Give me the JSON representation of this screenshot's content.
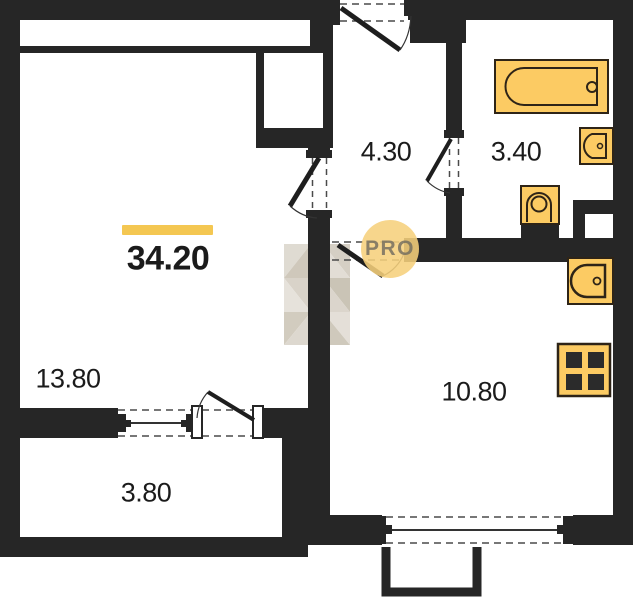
{
  "meta": {
    "type": "apartment-floor-plan"
  },
  "total_area": {
    "value": "34.20"
  },
  "rooms": {
    "living": {
      "area": "13.80"
    },
    "hallway": {
      "area": "4.30"
    },
    "bathroom": {
      "area": "3.40"
    },
    "kitchen": {
      "area": "10.80"
    },
    "balcony": {
      "area": "3.80"
    }
  },
  "watermark": {
    "badge": "PRO"
  },
  "colors": {
    "wall": "#262626",
    "fixture_fill": "#fccb63",
    "fixture_outline": "#2e2417",
    "accent_bar": "#f4c752",
    "badge_bg": "#f6d07c",
    "label_text": "#1b1b1b"
  }
}
